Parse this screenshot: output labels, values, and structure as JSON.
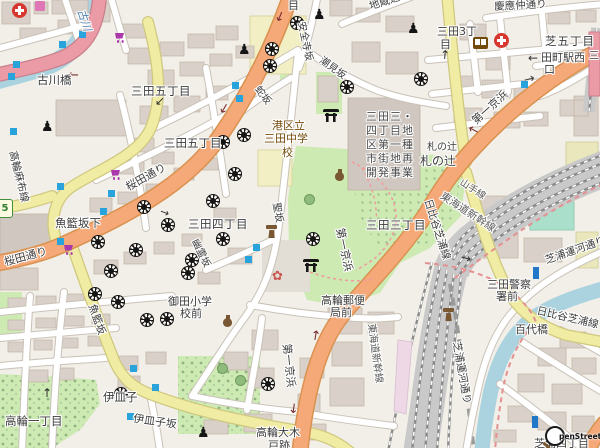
{
  "attribution": {
    "text": "penStreetMap"
  },
  "route_shield": {
    "ref": "5"
  },
  "colors": {
    "background": "#f2efe9",
    "building": "#d9d0c9",
    "water": "#aad3df",
    "park": "#cdeab3",
    "trunk_pink": "#eb9ba5",
    "primary_orange": "#f5a878",
    "secondary_yellow": "#f0eca4",
    "railway": "#c9c9c9",
    "pitch_teal": "#aae0cb",
    "bus_marker": "#29a3dc",
    "shop_purple": "#ac39ac",
    "amenity_brown": "#734a08",
    "boundary_red": "#e39191",
    "school_yellow": "#f2efc5"
  },
  "labels": [
    {
      "n": "label-me-partial",
      "t": "目",
      "x": 288,
      "y": 0,
      "s": 11
    },
    {
      "n": "label-jizo-dori",
      "t": "地蔵通り",
      "x": 368,
      "y": 2,
      "s": 10.5,
      "r": -18
    },
    {
      "n": "label-keio-nakadori",
      "t": "慶應仲通り",
      "x": 494,
      "y": 2,
      "s": 10.5,
      "r": -3
    },
    {
      "n": "label-shiba-5chome",
      "t": "芝五丁目",
      "x": 545,
      "y": 35,
      "s": 11.5,
      "ls": 1
    },
    {
      "n": "label-mita3-l1",
      "t": "三田3丁",
      "x": 437,
      "y": 26,
      "s": 11
    },
    {
      "n": "label-mita3-l2",
      "t": "目",
      "x": 440,
      "y": 39,
      "s": 11
    },
    {
      "n": "label-tamachi-west-l1",
      "t": "田町駅西",
      "x": 541,
      "y": 52,
      "s": 11
    },
    {
      "n": "label-tamachi-west-l2",
      "t": "口",
      "x": 544,
      "y": 64,
      "s": 11
    },
    {
      "n": "label-furukawa-river",
      "t": "古川",
      "x": 86,
      "y": 8,
      "s": 11,
      "r": 72,
      "c": "#4d7dad",
      "i": 1
    },
    {
      "n": "label-furukawabashi",
      "t": "古川橋",
      "x": 37,
      "y": 74,
      "s": 11.5
    },
    {
      "n": "label-mita5-a",
      "t": "三田五丁目",
      "x": 131,
      "y": 85,
      "s": 11.5,
      "ls": 0.5
    },
    {
      "n": "label-mita5-b",
      "t": "三田五丁目",
      "x": 164,
      "y": 137,
      "s": 11.5
    },
    {
      "n": "label-anzenji-zaka",
      "t": "安全寺坂",
      "x": 305,
      "y": 21,
      "s": 10,
      "r": 78
    },
    {
      "n": "label-shiomi-zaka",
      "t": "潮見坂",
      "x": 323,
      "y": 56,
      "s": 10,
      "r": 36
    },
    {
      "n": "label-hebi-zaka",
      "t": "蛇坂",
      "x": 260,
      "y": 85,
      "s": 10,
      "r": 52
    },
    {
      "n": "label-school-l1",
      "t": "港区立",
      "x": 272,
      "y": 120,
      "s": 11,
      "c": "#734a08"
    },
    {
      "n": "label-school-l2",
      "t": "三田中学",
      "x": 264,
      "y": 133,
      "s": 11,
      "c": "#734a08"
    },
    {
      "n": "label-school-l3",
      "t": "校",
      "x": 282,
      "y": 147,
      "s": 11,
      "c": "#734a08"
    },
    {
      "n": "label-redev-l1",
      "t": "三田三・",
      "x": 366,
      "y": 111,
      "s": 11,
      "c": "#4a4a4a",
      "ls": 1
    },
    {
      "n": "label-redev-l2",
      "t": "四丁目地",
      "x": 366,
      "y": 125,
      "s": 11,
      "c": "#4a4a4a",
      "ls": 1
    },
    {
      "n": "label-redev-l3",
      "t": "区第一種",
      "x": 366,
      "y": 139,
      "s": 11,
      "c": "#4a4a4a",
      "ls": 1
    },
    {
      "n": "label-redev-l4",
      "t": "市街地再",
      "x": 366,
      "y": 153,
      "s": 11,
      "c": "#4a4a4a",
      "ls": 1
    },
    {
      "n": "label-redev-l5",
      "t": "開発事業",
      "x": 366,
      "y": 167,
      "s": 11,
      "c": "#4a4a4a",
      "ls": 1
    },
    {
      "n": "label-fudanotsuji-small",
      "t": "札の辻",
      "x": 427,
      "y": 143,
      "s": 10
    },
    {
      "n": "label-fudanotsuji",
      "t": "札の辻",
      "x": 420,
      "y": 155,
      "s": 12
    },
    {
      "n": "label-daiichi-keihin-a",
      "t": "第一京浜",
      "x": 470,
      "y": 118,
      "s": 11,
      "r": -42
    },
    {
      "n": "label-takanawa-azabu-line",
      "t": "高輪麻布線",
      "x": 17,
      "y": 150,
      "s": 10.5,
      "r": 76
    },
    {
      "n": "label-sakurada-dori-a",
      "t": "桜田通り",
      "x": 124,
      "y": 183,
      "s": 11,
      "r": -29
    },
    {
      "n": "label-sakurada-dori-b",
      "t": "桜田通り",
      "x": 3,
      "y": 257,
      "s": 11,
      "r": -15
    },
    {
      "n": "label-mita4",
      "t": "三田四丁目",
      "x": 188,
      "y": 218,
      "s": 11.5,
      "ls": 0.5
    },
    {
      "n": "label-yurei-zaka",
      "t": "幽霊坂",
      "x": 198,
      "y": 238,
      "s": 10,
      "r": 64
    },
    {
      "n": "label-hijiri-zaka",
      "t": "聖坂",
      "x": 280,
      "y": 202,
      "s": 10,
      "r": 80
    },
    {
      "n": "label-gyoran-zaka-shita",
      "t": "魚籃坂下",
      "x": 55,
      "y": 217,
      "s": 11.5
    },
    {
      "n": "label-mita3-chome",
      "t": "三田三丁目",
      "x": 366,
      "y": 219,
      "s": 11.5,
      "ls": 0.5
    },
    {
      "n": "label-hibiya-shibaura-a",
      "t": "日比谷芝浦線",
      "x": 432,
      "y": 198,
      "s": 10.5,
      "r": 72
    },
    {
      "n": "label-yamanote-line",
      "t": "山手線",
      "x": 463,
      "y": 178,
      "s": 9.5,
      "r": 33,
      "c": "#5a5a5a"
    },
    {
      "n": "label-shinkansen-a",
      "t": "東海道新幹線",
      "x": 444,
      "y": 191,
      "s": 10.5,
      "r": 33,
      "c": "#5a5a5a"
    },
    {
      "n": "label-gyoran-zaka",
      "t": "魚籃坂",
      "x": 96,
      "y": 303,
      "s": 10.5,
      "r": 70
    },
    {
      "n": "label-mita-police-l1",
      "t": "三田警察",
      "x": 487,
      "y": 279,
      "s": 11
    },
    {
      "n": "label-mita-police-l2",
      "t": "署前",
      "x": 496,
      "y": 291,
      "s": 11
    },
    {
      "n": "label-shibaura-canal-a",
      "t": "芝浦運河通り",
      "x": 544,
      "y": 256,
      "s": 10.5,
      "r": -19
    },
    {
      "n": "label-hyakudai-bashi",
      "t": "百代橋",
      "x": 515,
      "y": 324,
      "s": 11
    },
    {
      "n": "label-hibiya-shibaura-b",
      "t": "日比谷芝浦線",
      "x": 538,
      "y": 306,
      "s": 10.5,
      "r": 13
    },
    {
      "n": "label-takanawa-post-l1",
      "t": "高輪郵便",
      "x": 321,
      "y": 295,
      "s": 11
    },
    {
      "n": "label-takanawa-post-l2",
      "t": "局前",
      "x": 330,
      "y": 307,
      "s": 11
    },
    {
      "n": "label-shinkansen-b",
      "t": "東海道新幹線",
      "x": 375,
      "y": 323,
      "s": 10,
      "r": 82,
      "c": "#5a5a5a"
    },
    {
      "n": "label-daiichi-keihin-b",
      "t": "第一京浜",
      "x": 345,
      "y": 227,
      "s": 11,
      "r": 78
    },
    {
      "n": "label-daiichi-keihin-c",
      "t": "第一京浜",
      "x": 292,
      "y": 343,
      "s": 11,
      "r": 84
    },
    {
      "n": "label-shibaura-canal-b",
      "t": "芝浦運河通り",
      "x": 461,
      "y": 341,
      "s": 10.5,
      "r": 80
    },
    {
      "n": "label-isarago",
      "t": "伊皿子",
      "x": 103,
      "y": 391,
      "s": 11.5
    },
    {
      "n": "label-isarago-zaka",
      "t": "伊皿子坂",
      "x": 134,
      "y": 413,
      "s": 11,
      "r": 8
    },
    {
      "n": "label-takanawa-1chome",
      "t": "高輪一丁目",
      "x": 5,
      "y": 415,
      "s": 11.5
    },
    {
      "n": "label-mita-elementary-l1",
      "t": "御田小学",
      "x": 168,
      "y": 296,
      "s": 11
    },
    {
      "n": "label-mita-elementary-l2",
      "t": "校前",
      "x": 180,
      "y": 308,
      "s": 11
    },
    {
      "n": "label-okido-l1",
      "t": "高輪大木",
      "x": 256,
      "y": 427,
      "s": 11
    },
    {
      "n": "label-okido-l2",
      "t": "戸跡",
      "x": 268,
      "y": 440,
      "s": 11
    },
    {
      "n": "label-shibaura-4chome",
      "t": "芝浦四丁目",
      "x": 534,
      "y": 438,
      "s": 11
    },
    {
      "n": "label-mi-partial",
      "t": "三",
      "x": 589,
      "y": 52,
      "s": 10
    }
  ],
  "icons": [
    {
      "k": "wheel",
      "n": "temple-icon",
      "x": 290,
      "y": 16
    },
    {
      "k": "wheel",
      "n": "temple-icon",
      "x": 265,
      "y": 42
    },
    {
      "k": "wheel",
      "n": "temple-icon",
      "x": 263,
      "y": 59
    },
    {
      "k": "wheel",
      "n": "temple-icon",
      "x": 340,
      "y": 80
    },
    {
      "k": "wheel",
      "n": "temple-icon",
      "x": 414,
      "y": 72
    },
    {
      "k": "wheel",
      "n": "temple-icon",
      "x": 216,
      "y": 135
    },
    {
      "k": "wheel",
      "n": "temple-icon",
      "x": 237,
      "y": 128
    },
    {
      "k": "wheel",
      "n": "temple-icon",
      "x": 137,
      "y": 200
    },
    {
      "k": "wheel",
      "n": "temple-icon",
      "x": 161,
      "y": 218
    },
    {
      "k": "wheel",
      "n": "temple-icon",
      "x": 185,
      "y": 253
    },
    {
      "k": "wheel",
      "n": "temple-icon",
      "x": 91,
      "y": 235
    },
    {
      "k": "wheel",
      "n": "temple-icon",
      "x": 129,
      "y": 243
    },
    {
      "k": "wheel",
      "n": "temple-icon",
      "x": 104,
      "y": 264
    },
    {
      "k": "wheel",
      "n": "temple-icon",
      "x": 181,
      "y": 266
    },
    {
      "k": "wheel",
      "n": "temple-icon",
      "x": 88,
      "y": 287
    },
    {
      "k": "wheel",
      "n": "temple-icon",
      "x": 228,
      "y": 167
    },
    {
      "k": "wheel",
      "n": "temple-icon",
      "x": 206,
      "y": 194
    },
    {
      "k": "wheel",
      "n": "temple-icon",
      "x": 216,
      "y": 232
    },
    {
      "k": "wheel",
      "n": "temple-icon",
      "x": 306,
      "y": 232
    },
    {
      "k": "wheel",
      "n": "temple-icon",
      "x": 111,
      "y": 295
    },
    {
      "k": "wheel",
      "n": "temple-icon",
      "x": 140,
      "y": 313
    },
    {
      "k": "wheel",
      "n": "temple-icon",
      "x": 160,
      "y": 312
    },
    {
      "k": "wheel",
      "n": "temple-icon",
      "x": 114,
      "y": 387
    },
    {
      "k": "wheel",
      "n": "temple-icon",
      "x": 261,
      "y": 377
    },
    {
      "k": "torii",
      "n": "shrine-torii-icon",
      "x": 323,
      "y": 109
    },
    {
      "k": "torii",
      "n": "shrine-torii-icon",
      "x": 303,
      "y": 259
    },
    {
      "k": "statue",
      "n": "statue-icon",
      "x": 41,
      "y": 120,
      "t": "♟",
      "s": 14,
      "c": "#161616"
    },
    {
      "k": "statue",
      "n": "statue-icon",
      "x": 313,
      "y": 8,
      "t": "♟",
      "s": 14,
      "c": "#161616"
    },
    {
      "k": "statue",
      "n": "statue-icon",
      "x": 238,
      "y": 43,
      "t": "♟",
      "s": 14,
      "c": "#161616"
    },
    {
      "k": "statue",
      "n": "statue-icon",
      "x": 407,
      "y": 22,
      "t": "♟",
      "s": 14,
      "c": "#161616"
    },
    {
      "k": "statue",
      "n": "statue-icon",
      "x": 197,
      "y": 426,
      "t": "♟",
      "s": 14,
      "c": "#161616"
    },
    {
      "k": "hospital",
      "n": "hospital-icon",
      "x": 12,
      "y": 3
    },
    {
      "k": "hospital",
      "n": "hospital-icon",
      "x": 494,
      "y": 33
    },
    {
      "k": "book",
      "n": "library-icon",
      "x": 473,
      "y": 37
    },
    {
      "k": "cart",
      "n": "supermarket-icon",
      "x": 113,
      "y": 32
    },
    {
      "k": "cart",
      "n": "supermarket-icon",
      "x": 109,
      "y": 169
    },
    {
      "k": "cart",
      "n": "supermarket-icon",
      "x": 62,
      "y": 244
    },
    {
      "k": "shopfront",
      "n": "shop-icon",
      "x": 35,
      "y": 1
    },
    {
      "k": "amphora",
      "n": "historic-amphora-icon",
      "x": 335,
      "y": 169
    },
    {
      "k": "amphora",
      "n": "historic-amphora-icon",
      "x": 223,
      "y": 315
    },
    {
      "k": "monument",
      "n": "monument-icon",
      "x": 266,
      "y": 224
    },
    {
      "k": "monument",
      "n": "monument-icon",
      "x": 443,
      "y": 307
    },
    {
      "k": "flower",
      "n": "garden-flower-icon",
      "x": 272,
      "y": 270,
      "t": "✿",
      "s": 13,
      "c": "#c9574f"
    },
    {
      "k": "tree",
      "n": "tree-icon",
      "x": 304,
      "y": 194
    },
    {
      "k": "tree",
      "n": "tree-icon",
      "x": 217,
      "y": 363
    },
    {
      "k": "tree",
      "n": "tree-icon",
      "x": 235,
      "y": 375
    },
    {
      "k": "blue",
      "n": "bus-stop-marker",
      "x": 79,
      "y": 31
    },
    {
      "k": "blue",
      "n": "bus-stop-marker",
      "x": 59,
      "y": 41
    },
    {
      "k": "blue",
      "n": "bus-stop-marker",
      "x": 13,
      "y": 61
    },
    {
      "k": "blue",
      "n": "bus-stop-marker",
      "x": 8,
      "y": 73
    },
    {
      "k": "blue",
      "n": "bus-stop-marker",
      "x": 232,
      "y": 82
    },
    {
      "k": "blue",
      "n": "bus-stop-marker",
      "x": 236,
      "y": 95
    },
    {
      "k": "blue",
      "n": "bus-stop-marker",
      "x": 57,
      "y": 183
    },
    {
      "k": "blue",
      "n": "bus-stop-marker",
      "x": 108,
      "y": 190
    },
    {
      "k": "blue",
      "n": "bus-stop-marker",
      "x": 100,
      "y": 208
    },
    {
      "k": "blue",
      "n": "bus-stop-marker",
      "x": 57,
      "y": 238
    },
    {
      "k": "blue",
      "n": "bus-stop-marker",
      "x": 253,
      "y": 244
    },
    {
      "k": "blue",
      "n": "bus-stop-marker",
      "x": 245,
      "y": 256
    },
    {
      "k": "blue",
      "n": "bus-stop-marker",
      "x": 130,
      "y": 365
    },
    {
      "k": "blue",
      "n": "bus-stop-marker",
      "x": 152,
      "y": 384
    },
    {
      "k": "blue",
      "n": "bus-stop-marker",
      "x": 127,
      "y": 413
    },
    {
      "k": "blue",
      "n": "bus-stop-marker",
      "x": 521,
      "y": 81
    },
    {
      "k": "blue",
      "n": "bus-stop-marker",
      "x": 10,
      "y": 128
    },
    {
      "k": "busv",
      "n": "stop-marker-tall",
      "x": 533,
      "y": 267
    },
    {
      "k": "busv",
      "n": "stop-marker-tall",
      "x": 532,
      "y": 416
    },
    {
      "k": "shield",
      "n": "route-shield-5",
      "x": -3,
      "y": 199,
      "t": "5",
      "s": 10
    },
    {
      "k": "arrow",
      "n": "oneway-arrow",
      "x": 68,
      "y": 69,
      "t": "←",
      "s": 13,
      "c": "#7a2e2e"
    },
    {
      "k": "arrow",
      "n": "oneway-arrow",
      "x": 274,
      "y": 11,
      "t": "↓",
      "s": 13,
      "r": 22,
      "c": "#7a2e2e"
    },
    {
      "k": "arrow",
      "n": "oneway-arrow",
      "x": 218,
      "y": 103,
      "t": "↓",
      "s": 13,
      "r": 30,
      "c": "#7a2e2e"
    },
    {
      "k": "arrow",
      "n": "oneway-arrow",
      "x": 468,
      "y": 124,
      "t": "←",
      "s": 13,
      "r": 28,
      "c": "#7a2e2e"
    },
    {
      "k": "arrow",
      "n": "oneway-arrow",
      "x": 310,
      "y": 330,
      "t": "↑",
      "s": 13,
      "r": 10,
      "c": "#7a2e2e"
    },
    {
      "k": "arrow",
      "n": "oneway-arrow",
      "x": 288,
      "y": 403,
      "t": "↓",
      "s": 13,
      "r": 8,
      "c": "#7a2e2e"
    },
    {
      "k": "arrow",
      "n": "oneway-arrow",
      "x": 524,
      "y": 73,
      "t": "→",
      "s": 13,
      "r": -14,
      "c": "#444"
    },
    {
      "k": "arrow",
      "n": "direction-arrow",
      "x": 528,
      "y": 52,
      "t": "←",
      "s": 12,
      "c": "#333"
    },
    {
      "k": "arrow",
      "n": "direction-arrow",
      "x": 440,
      "y": 49,
      "t": "↑",
      "s": 12,
      "r": 5,
      "c": "#333"
    },
    {
      "k": "arrow",
      "n": "direction-arrow",
      "x": 461,
      "y": 252,
      "t": "→",
      "s": 12,
      "r": 14,
      "c": "#333"
    },
    {
      "k": "arrow",
      "n": "direction-arrow",
      "x": 42,
      "y": 387,
      "t": "↑",
      "s": 12,
      "c": "#333"
    },
    {
      "k": "arrow",
      "n": "direction-arrow",
      "x": 155,
      "y": 95,
      "t": "↙",
      "s": 12,
      "c": "#333"
    },
    {
      "k": "arrow",
      "n": "direction-arrow",
      "x": 160,
      "y": 207,
      "t": "→",
      "s": 11,
      "r": 20,
      "c": "#333"
    }
  ]
}
